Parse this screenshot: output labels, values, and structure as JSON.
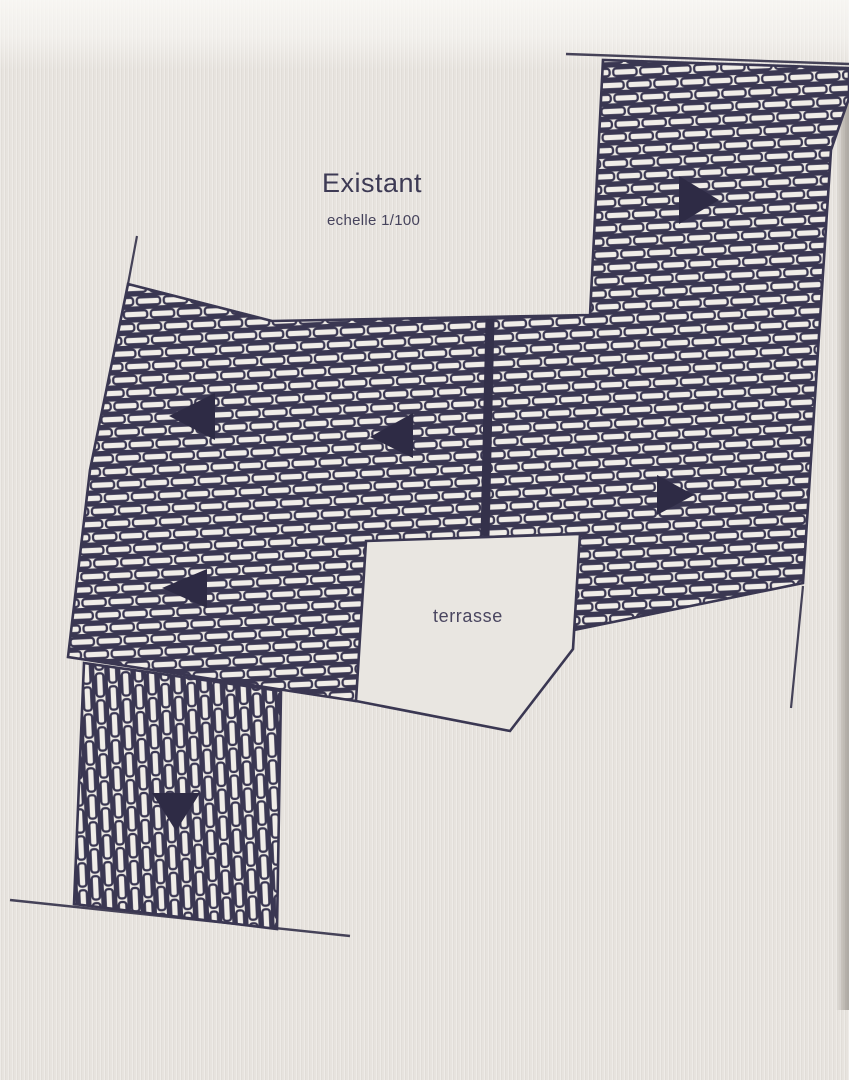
{
  "document": {
    "title": "Existant",
    "scale_note": "echelle 1/100",
    "terrace_label": "terrasse",
    "kind": "roof plan drawing (existing state)"
  },
  "drawing": {
    "colors": {
      "ink": "#3a3752",
      "paper": "#e7e3de",
      "tile_fill": "#efece7",
      "arrow": "#2e2b45"
    },
    "slope_arrows": [
      {
        "id": "arrow-top-right",
        "direction": "right"
      },
      {
        "id": "arrow-middle-west",
        "direction": "left"
      },
      {
        "id": "arrow-middle-center",
        "direction": "left"
      },
      {
        "id": "arrow-right-lower",
        "direction": "right"
      },
      {
        "id": "arrow-lower-left",
        "direction": "left"
      },
      {
        "id": "arrow-bottom-column",
        "direction": "down"
      }
    ],
    "regions": [
      {
        "id": "main-roof",
        "hatch": "horizontal-tiles"
      },
      {
        "id": "bottom-roof-column",
        "hatch": "vertical-tiles"
      },
      {
        "id": "terrace",
        "hatch": "none"
      }
    ]
  }
}
